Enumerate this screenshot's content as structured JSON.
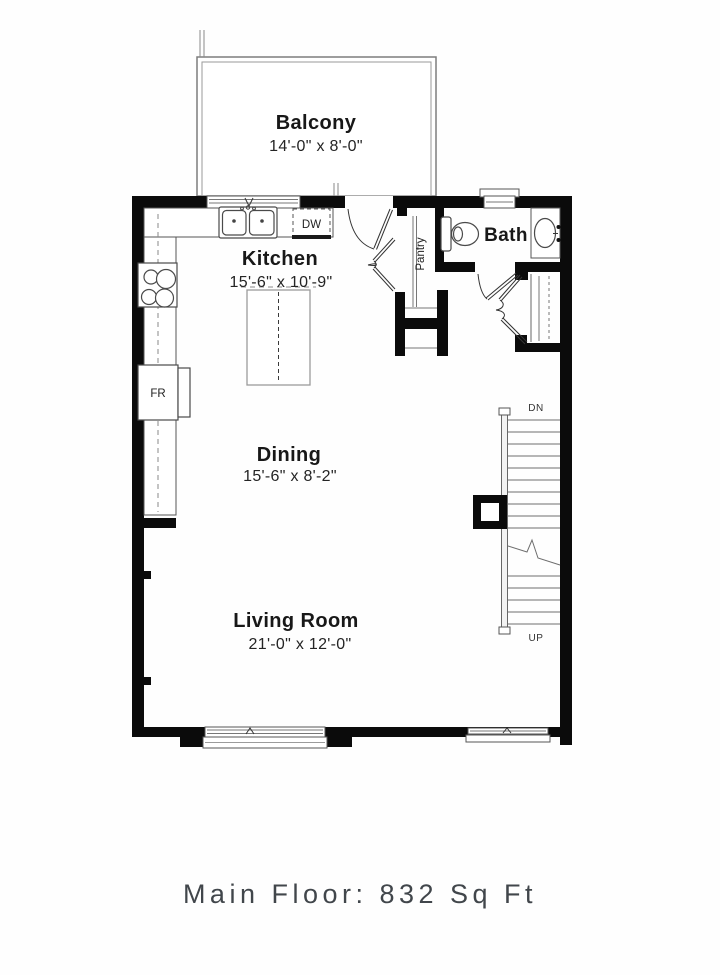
{
  "floor_plan": {
    "balcony": {
      "name": "Balcony",
      "dims": "14'-0\" x 8'-0\""
    },
    "kitchen": {
      "name": "Kitchen",
      "dims": "15'-6\" x 10'-9\""
    },
    "dining": {
      "name": "Dining",
      "dims": "15'-6\" x 8'-2\""
    },
    "living_room": {
      "name": "Living Room",
      "dims": "21'-0\" x 12'-0\""
    },
    "bath": {
      "name": "Bath"
    },
    "pantry": {
      "name": "Pantry"
    },
    "labels": {
      "dishwasher": "DW",
      "fridge": "FR",
      "stairs_down": "DN",
      "stairs_up": "UP"
    }
  },
  "footer": {
    "text": "Main Floor: 832 Sq Ft"
  },
  "colors": {
    "wall": "#0b0b0b",
    "fixture_line": "#4a4a4a",
    "light_line": "#9b9b9b",
    "text": "#181818",
    "footer_text": "#41464b",
    "background": "#fefefe"
  }
}
